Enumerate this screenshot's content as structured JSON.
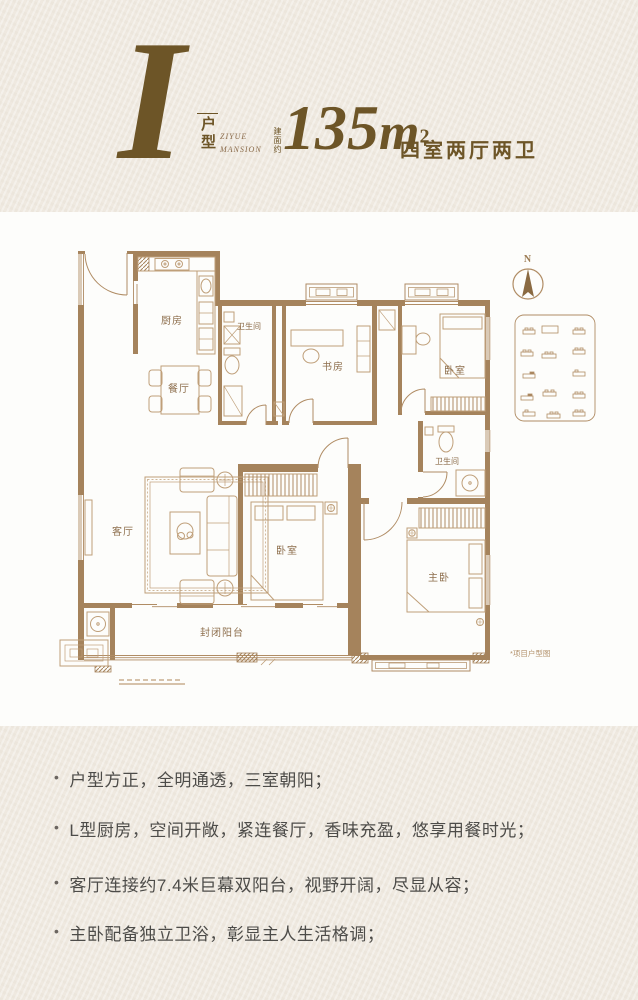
{
  "header": {
    "plan_letter": "I",
    "plan_type_vertical": "户型",
    "subtitle_en_line1": "ZIYUE",
    "subtitle_en_line2": "MANSION",
    "area_prefix": "建面约",
    "area_value": "135",
    "area_unit": "m",
    "area_sup": "2",
    "layout_text": "四室两厅两卫"
  },
  "floor_plan": {
    "compass_label": "N",
    "note": "*项目户型图",
    "rooms": [
      {
        "label": "厨房"
      },
      {
        "label": "卫生间"
      },
      {
        "label": "餐厅"
      },
      {
        "label": "书房"
      },
      {
        "label": "卧室"
      },
      {
        "label": "卫生间"
      },
      {
        "label": "客厅"
      },
      {
        "label": "卧室"
      },
      {
        "label": "主卧"
      },
      {
        "label": "封闭阳台"
      }
    ]
  },
  "features": {
    "bullet_char": "•",
    "items": [
      "户型方正，全明通透，三室朝阳；",
      "L型厨房，空间开敞，紧连餐厅，香味充盈，悠享用餐时光；",
      "客厅连接约7.4米巨幕双阳台，视野开阔，尽显从容；",
      "主卧配备独立卫浴，彰显主人生活格调；"
    ]
  },
  "colors": {
    "background": "#efe9e0",
    "card": "#fdfdfb",
    "wall": "#a5835c",
    "line": "#b08c64",
    "accent": "#6d5527",
    "body_text": "#4d4c49"
  }
}
